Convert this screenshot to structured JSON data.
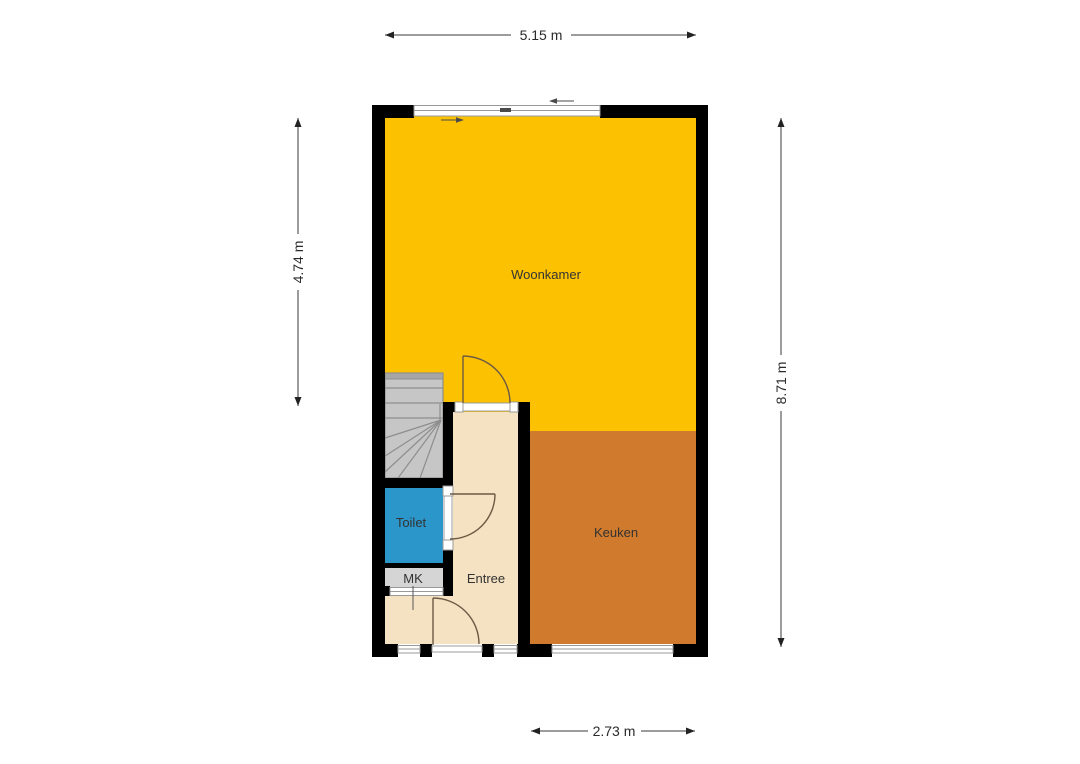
{
  "floorplan": {
    "dimensions": {
      "top": "5.15 m",
      "left": "4.74 m",
      "right": "8.71 m",
      "bottom": "2.73 m"
    },
    "rooms": {
      "woonkamer": {
        "label": "Woonkamer",
        "color": "#FCC101"
      },
      "keuken": {
        "label": "Keuken",
        "color": "#D07A2D"
      },
      "toilet": {
        "label": "Toilet",
        "color": "#2A96C9"
      },
      "entree": {
        "label": "Entree",
        "color": "#F5E2C2"
      },
      "mk": {
        "label": "MK",
        "color": "#D5D5D5"
      }
    },
    "stairs": {
      "fill": "#C6C6C6",
      "top_bar": "#A6A6A6"
    },
    "structure_colors": {
      "wall": "#000000",
      "window_line": "#999999",
      "door_arc": "#6D5A44",
      "dimension_line": "#3A3A3A",
      "label_text": "#333333"
    }
  }
}
